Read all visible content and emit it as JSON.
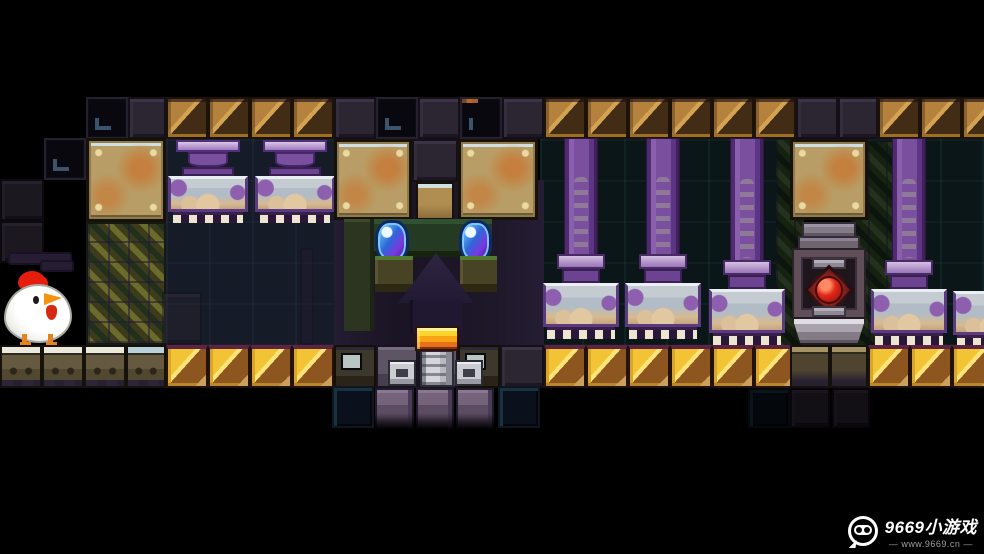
{
  "meta": {
    "width": 984,
    "height": 554,
    "scene_name": "pixel-platformer-temple"
  },
  "watermark": {
    "brand": "9669小游戏",
    "url": "— www.9669.cn —"
  },
  "palette": {
    "bg_black": "#000000",
    "hazard_gold": "#f2c435",
    "hazard_brown": "#8d5620",
    "hazard_dim_tan": "#b5823e",
    "pillar_purple": "#8257a3",
    "capital_gray": "#b2bcc6",
    "gem_blue": "#2f6fe0",
    "crown_orange": "#f09a1e",
    "orb_red": "#d42020",
    "brass_tan": "#b89e66",
    "lattice_olive": "#6b6b2c",
    "chicken_white": "#ffffff",
    "comb_red": "#e41d0e"
  },
  "defs": {
    "chand": [
      {
        "n": "pillar-cap",
        "c": "chand-cap",
        "x": 8,
        "y": 0,
        "w": 64,
        "h": 12
      },
      {
        "n": "pillar-bulb",
        "c": "chand-bulb",
        "x": 20,
        "y": 12,
        "w": 40,
        "h": 15
      },
      {
        "n": "pillar-neck",
        "c": "p-neck",
        "x": 14,
        "y": 27,
        "w": 52,
        "h": 9
      },
      {
        "n": "pillar-capital",
        "c": "p-cap",
        "x": 0,
        "y": 36,
        "w": 80,
        "h": 36
      },
      {
        "n": "pillar-teeth",
        "c": "p-teeth",
        "x": 5,
        "y": 72,
        "w": 70,
        "h": 11
      }
    ],
    "pillar": [
      {
        "n": "pillar-shaft",
        "c": "p-shaft",
        "x": 21,
        "y": 0,
        "w": 34,
        "h": 120
      },
      {
        "n": "pillar-collar",
        "c": "p-collar",
        "x": 14,
        "y": 116,
        "w": 48,
        "h": 15
      },
      {
        "n": "pillar-neck",
        "c": "p-neck",
        "x": 19,
        "y": 131,
        "w": 38,
        "h": 14
      },
      {
        "n": "pillar-capital",
        "c": "p-cap",
        "x": 0,
        "y": 145,
        "w": 76,
        "h": 44
      },
      {
        "n": "pillar-teeth",
        "c": "p-teeth",
        "x": 4,
        "y": 189,
        "w": 68,
        "h": 12
      }
    ],
    "pillar_tall": [
      {
        "n": "pillar-shaft",
        "c": "p-shaft",
        "x": 21,
        "y": 0,
        "w": 34,
        "h": 126
      },
      {
        "n": "pillar-collar",
        "c": "p-collar",
        "x": 14,
        "y": 122,
        "w": 48,
        "h": 15
      },
      {
        "n": "pillar-neck",
        "c": "p-neck",
        "x": 19,
        "y": 137,
        "w": 38,
        "h": 14
      },
      {
        "n": "pillar-capital",
        "c": "p-cap",
        "x": 0,
        "y": 151,
        "w": 76,
        "h": 44
      },
      {
        "n": "pillar-teeth",
        "c": "p-teeth",
        "x": 4,
        "y": 195,
        "w": 68,
        "h": 12
      }
    ],
    "cap_only": [
      {
        "n": "pillar-capital",
        "c": "p-cap",
        "x": 0,
        "y": 153,
        "w": 76,
        "h": 44
      },
      {
        "n": "pillar-teeth",
        "c": "p-teeth",
        "x": 4,
        "y": 197,
        "w": 68,
        "h": 10
      }
    ],
    "totem": [
      {
        "n": "totem-head",
        "c": "t-head",
        "x": 8,
        "y": 0,
        "w": 54,
        "h": 16
      },
      {
        "n": "totem-head",
        "c": "t-head2",
        "x": 4,
        "y": 14,
        "w": 62,
        "h": 16
      },
      {
        "n": "totem-body",
        "c": "t-body",
        "x": 0,
        "y": 28,
        "w": 70,
        "h": 67
      },
      {
        "n": "totem-slot",
        "c": "t-bar",
        "x": 18,
        "y": 36,
        "w": 34,
        "h": 11
      },
      {
        "n": "orb-frame",
        "c": "t-orbframe",
        "x": 17,
        "y": 50,
        "w": 36,
        "h": 36
      },
      {
        "n": "red-orb",
        "c": "t-orb",
        "x": 21,
        "y": 54,
        "w": 28,
        "h": 28
      },
      {
        "n": "totem-slot",
        "c": "t-bar",
        "x": 18,
        "y": 84,
        "w": 34,
        "h": 11
      },
      {
        "n": "totem-base",
        "c": "t-base",
        "x": -2,
        "y": 95,
        "w": 74,
        "h": 28
      }
    ],
    "chicken": [
      {
        "n": "chicken-comb",
        "c": "c-comb",
        "x": 14,
        "y": 0,
        "w": 28,
        "h": 20
      },
      {
        "n": "chicken-comb",
        "c": "c-comb2",
        "x": 30,
        "y": 5,
        "w": 14,
        "h": 13
      },
      {
        "n": "chicken-body",
        "c": "c-body",
        "x": 0,
        "y": 13,
        "w": 68,
        "h": 59
      },
      {
        "n": "chicken-eye",
        "c": "c-eye",
        "x": 29,
        "y": 25,
        "w": 6,
        "h": 8
      },
      {
        "n": "chicken-beak",
        "c": "c-beak",
        "x": 40,
        "y": 21,
        "w": 18,
        "h": 14
      },
      {
        "n": "chicken-wattle",
        "c": "c-wattle",
        "x": 42,
        "y": 34,
        "w": 11,
        "h": 15
      },
      {
        "n": "chicken-leg",
        "c": "c-leg",
        "x": 18,
        "y": 63,
        "w": 5,
        "h": 11
      },
      {
        "n": "chicken-leg",
        "c": "c-leg",
        "x": 44,
        "y": 63,
        "w": 5,
        "h": 11
      }
    ]
  },
  "scene": [
    {
      "n": "background-wall",
      "c": "wall-dark",
      "x": 166,
      "y": 139,
      "w": 170,
      "h": 206
    },
    {
      "n": "background-wall",
      "c": "wall-teal",
      "x": 540,
      "y": 139,
      "w": 250,
      "h": 206
    },
    {
      "n": "background-wall",
      "c": "wall-teal",
      "x": 856,
      "y": 139,
      "w": 128,
      "h": 206
    },
    {
      "n": "face-wall",
      "c": "face-bg",
      "x": 334,
      "y": 180,
      "w": 210,
      "h": 168
    },
    {
      "n": "grate-strip",
      "c": "lattice-dk",
      "x": 776,
      "y": 140,
      "w": 28,
      "h": 205
    },
    {
      "n": "grate-strip",
      "c": "lattice-dk",
      "x": 850,
      "y": 142,
      "w": 44,
      "h": 203
    },
    {
      "n": "wall-block",
      "c": "blk-solid dim",
      "x": 0,
      "y": 179,
      "w": 44,
      "h": 42
    },
    {
      "n": "wall-block",
      "c": "blk-solid dim",
      "x": 0,
      "y": 221,
      "w": 44,
      "h": 42
    },
    {
      "n": "pipe",
      "c": "pipe",
      "x": 8,
      "y": 252,
      "w": 64,
      "h": 13
    },
    {
      "n": "pipe",
      "c": "pipe",
      "x": 40,
      "y": 260,
      "w": 34,
      "h": 12
    },
    {
      "n": "wall-block",
      "c": "blk-frame",
      "x": 44,
      "y": 138,
      "w": 42,
      "h": 42
    },
    {
      "n": "ceiling-block",
      "c": "blk-frame",
      "x": 86,
      "y": 97,
      "w": 42,
      "h": 42
    },
    {
      "n": "ceiling-block",
      "c": "blk-solid",
      "x": 128,
      "y": 97,
      "w": 38,
      "h": 42
    },
    {
      "n": "hazard-block",
      "c": "hazard-d",
      "x": 166,
      "y": 97,
      "w": 42,
      "h": 42
    },
    {
      "n": "hazard-block",
      "c": "hazard-d",
      "x": 208,
      "y": 97,
      "w": 42,
      "h": 42
    },
    {
      "n": "hazard-block",
      "c": "hazard-d",
      "x": 250,
      "y": 97,
      "w": 42,
      "h": 42
    },
    {
      "n": "hazard-block",
      "c": "hazard-d",
      "x": 292,
      "y": 97,
      "w": 42,
      "h": 42
    },
    {
      "n": "ceiling-block",
      "c": "blk-solid",
      "x": 334,
      "y": 97,
      "w": 42,
      "h": 42
    },
    {
      "n": "ceiling-block",
      "c": "blk-frame",
      "x": 376,
      "y": 97,
      "w": 42,
      "h": 42
    },
    {
      "n": "ceiling-block",
      "c": "blk-solid",
      "x": 418,
      "y": 97,
      "w": 42,
      "h": 42
    },
    {
      "n": "ceiling-block",
      "c": "blk-frame rust",
      "x": 460,
      "y": 97,
      "w": 42,
      "h": 42
    },
    {
      "n": "ceiling-block",
      "c": "blk-solid",
      "x": 502,
      "y": 97,
      "w": 42,
      "h": 42
    },
    {
      "n": "hazard-block",
      "c": "hazard-d",
      "x": 544,
      "y": 97,
      "w": 42,
      "h": 42
    },
    {
      "n": "hazard-block",
      "c": "hazard-d",
      "x": 586,
      "y": 97,
      "w": 42,
      "h": 42
    },
    {
      "n": "hazard-block",
      "c": "hazard-d",
      "x": 628,
      "y": 97,
      "w": 42,
      "h": 42
    },
    {
      "n": "hazard-block",
      "c": "hazard-d",
      "x": 670,
      "y": 97,
      "w": 42,
      "h": 42
    },
    {
      "n": "hazard-block",
      "c": "hazard-d",
      "x": 712,
      "y": 97,
      "w": 42,
      "h": 42
    },
    {
      "n": "hazard-block",
      "c": "hazard-d",
      "x": 754,
      "y": 97,
      "w": 42,
      "h": 42
    },
    {
      "n": "ceiling-block",
      "c": "blk-solid",
      "x": 796,
      "y": 97,
      "w": 42,
      "h": 42
    },
    {
      "n": "ceiling-block",
      "c": "blk-solid",
      "x": 838,
      "y": 97,
      "w": 40,
      "h": 42
    },
    {
      "n": "hazard-block",
      "c": "hazard-d",
      "x": 878,
      "y": 97,
      "w": 42,
      "h": 42
    },
    {
      "n": "hazard-block",
      "c": "hazard-d",
      "x": 920,
      "y": 97,
      "w": 42,
      "h": 42
    },
    {
      "n": "hazard-block",
      "c": "hazard-d",
      "x": 962,
      "y": 97,
      "w": 42,
      "h": 42
    },
    {
      "n": "metal-plate",
      "c": "brass",
      "x": 86,
      "y": 138,
      "w": 80,
      "h": 84
    },
    {
      "n": "grate-wall",
      "c": "lattice",
      "x": 86,
      "y": 222,
      "w": 80,
      "h": 123
    },
    {
      "n": "hanging-pillar",
      "d": "chand",
      "x": 168,
      "y": 140
    },
    {
      "n": "hanging-pillar",
      "d": "chand",
      "x": 255,
      "y": 140
    },
    {
      "n": "rubble-block",
      "c": "blk-solid dim2",
      "x": 162,
      "y": 292,
      "w": 40,
      "h": 53
    },
    {
      "n": "pipe",
      "c": "pipe",
      "x": 300,
      "y": 248,
      "w": 14,
      "h": 97,
      "o": 0.45
    },
    {
      "n": "metal-plate",
      "c": "brass",
      "x": 334,
      "y": 139,
      "w": 78,
      "h": 81
    },
    {
      "n": "wall-block",
      "c": "blk-solid",
      "x": 412,
      "y": 139,
      "w": 46,
      "h": 43
    },
    {
      "n": "metal-plate",
      "c": "brass-sm",
      "x": 416,
      "y": 182,
      "w": 38,
      "h": 38
    },
    {
      "n": "metal-plate",
      "c": "brass",
      "x": 458,
      "y": 139,
      "w": 80,
      "h": 81
    },
    {
      "n": "face-column",
      "c": "f-col",
      "x": 344,
      "y": 219,
      "w": 30,
      "h": 112
    },
    {
      "n": "face-band",
      "c": "f-band",
      "x": 374,
      "y": 219,
      "w": 118,
      "h": 38
    },
    {
      "n": "gem-eye",
      "c": "gem",
      "x": 375,
      "y": 220,
      "w": 34,
      "h": 43
    },
    {
      "n": "gem-eye",
      "c": "gem",
      "x": 459,
      "y": 220,
      "w": 33,
      "h": 43
    },
    {
      "n": "face-ledge",
      "c": "f-ledge",
      "x": 375,
      "y": 256,
      "w": 38,
      "h": 36
    },
    {
      "n": "face-ledge",
      "c": "f-ledge",
      "x": 460,
      "y": 256,
      "w": 37,
      "h": 36
    },
    {
      "n": "face-nose",
      "c": "f-tri",
      "x": 398,
      "y": 253,
      "w": 76,
      "h": 50
    },
    {
      "n": "face-column",
      "c": "f-colmn",
      "x": 410,
      "y": 300,
      "w": 52,
      "h": 34
    },
    {
      "n": "pillar",
      "d": "pillar",
      "x": 543,
      "y": 138
    },
    {
      "n": "pillar",
      "d": "pillar",
      "x": 625,
      "y": 138
    },
    {
      "n": "pillar",
      "d": "pillar_tall",
      "x": 709,
      "y": 138
    },
    {
      "n": "metal-plate",
      "c": "brass",
      "x": 790,
      "y": 139,
      "w": 78,
      "h": 81
    },
    {
      "n": "orb-totem",
      "d": "totem",
      "x": 794,
      "y": 222
    },
    {
      "n": "pillar",
      "d": "pillar_tall",
      "x": 871,
      "y": 138
    },
    {
      "n": "pillar-capital",
      "d": "cap_only",
      "x": 953,
      "y": 138
    },
    {
      "n": "floor-ledge",
      "c": "ledge",
      "x": 0,
      "y": 345,
      "w": 42,
      "h": 43
    },
    {
      "n": "floor-ledge",
      "c": "ledge",
      "x": 42,
      "y": 345,
      "w": 42,
      "h": 43
    },
    {
      "n": "floor-ledge",
      "c": "ledge",
      "x": 84,
      "y": 345,
      "w": 42,
      "h": 43
    },
    {
      "n": "floor-ledge",
      "c": "ledge blue",
      "x": 126,
      "y": 345,
      "w": 40,
      "h": 43
    },
    {
      "n": "hazard-block",
      "c": "hazard-b",
      "x": 166,
      "y": 345,
      "w": 42,
      "h": 43
    },
    {
      "n": "hazard-block",
      "c": "hazard-b",
      "x": 208,
      "y": 345,
      "w": 42,
      "h": 43
    },
    {
      "n": "hazard-block",
      "c": "hazard-b",
      "x": 250,
      "y": 345,
      "w": 42,
      "h": 43
    },
    {
      "n": "hazard-block",
      "c": "hazard-b",
      "x": 292,
      "y": 345,
      "w": 42,
      "h": 43
    },
    {
      "n": "machine-block",
      "c": "window-blk",
      "x": 334,
      "y": 345,
      "w": 42,
      "h": 43
    },
    {
      "n": "machine-block",
      "c": "m-bg",
      "x": 376,
      "y": 345,
      "w": 42,
      "h": 43
    },
    {
      "n": "machine-block",
      "c": "m-bg",
      "x": 418,
      "y": 345,
      "w": 40,
      "h": 43
    },
    {
      "n": "machine-block",
      "c": "window-blk",
      "x": 458,
      "y": 345,
      "w": 42,
      "h": 43
    },
    {
      "n": "wall-block",
      "c": "blk-solid",
      "x": 500,
      "y": 345,
      "w": 44,
      "h": 43
    },
    {
      "n": "machine-part",
      "c": "m-box",
      "x": 388,
      "y": 360,
      "w": 28,
      "h": 26
    },
    {
      "n": "machine-piston",
      "c": "m-piston",
      "x": 420,
      "y": 350,
      "w": 34,
      "h": 37
    },
    {
      "n": "machine-part",
      "c": "m-box",
      "x": 455,
      "y": 360,
      "w": 28,
      "h": 26
    },
    {
      "n": "gold-crown",
      "c": "crown",
      "x": 415,
      "y": 326,
      "w": 44,
      "h": 25
    },
    {
      "n": "hazard-block",
      "c": "hazard-b",
      "x": 544,
      "y": 345,
      "w": 42,
      "h": 43
    },
    {
      "n": "hazard-block",
      "c": "hazard-b",
      "x": 586,
      "y": 345,
      "w": 42,
      "h": 43
    },
    {
      "n": "hazard-block",
      "c": "hazard-b",
      "x": 628,
      "y": 345,
      "w": 42,
      "h": 43
    },
    {
      "n": "hazard-block",
      "c": "hazard-b",
      "x": 670,
      "y": 345,
      "w": 42,
      "h": 43
    },
    {
      "n": "hazard-block",
      "c": "hazard-b",
      "x": 712,
      "y": 345,
      "w": 42,
      "h": 43
    },
    {
      "n": "hazard-block",
      "c": "hazard-b",
      "x": 754,
      "y": 345,
      "w": 42,
      "h": 43
    },
    {
      "n": "floor-ledge",
      "c": "ledge-dim",
      "x": 790,
      "y": 345,
      "w": 40,
      "h": 43
    },
    {
      "n": "floor-ledge",
      "c": "ledge-dim",
      "x": 830,
      "y": 345,
      "w": 38,
      "h": 43
    },
    {
      "n": "hazard-block",
      "c": "hazard-b",
      "x": 868,
      "y": 345,
      "w": 42,
      "h": 43
    },
    {
      "n": "hazard-block",
      "c": "hazard-b",
      "x": 910,
      "y": 345,
      "w": 42,
      "h": 43
    },
    {
      "n": "hazard-block",
      "c": "hazard-b",
      "x": 952,
      "y": 345,
      "w": 42,
      "h": 43
    },
    {
      "n": "frame-block",
      "c": "frameblk",
      "x": 332,
      "y": 386,
      "w": 42,
      "h": 42
    },
    {
      "n": "stone-block",
      "c": "stone",
      "x": 375,
      "y": 388,
      "w": 39,
      "h": 42
    },
    {
      "n": "stone-block",
      "c": "stone",
      "x": 416,
      "y": 388,
      "w": 38,
      "h": 42
    },
    {
      "n": "stone-block",
      "c": "stone",
      "x": 456,
      "y": 388,
      "w": 38,
      "h": 42
    },
    {
      "n": "frame-block",
      "c": "frameblk",
      "x": 498,
      "y": 386,
      "w": 42,
      "h": 42
    },
    {
      "n": "frame-block",
      "c": "frameblk dim2",
      "x": 748,
      "y": 388,
      "w": 42,
      "h": 40
    },
    {
      "n": "wall-block",
      "c": "blk-solid dim2",
      "x": 790,
      "y": 388,
      "w": 40,
      "h": 40
    },
    {
      "n": "wall-block",
      "c": "blk-solid dim2",
      "x": 832,
      "y": 388,
      "w": 38,
      "h": 40
    },
    {
      "n": "chicken-character",
      "d": "chicken",
      "x": 4,
      "y": 271
    }
  ]
}
